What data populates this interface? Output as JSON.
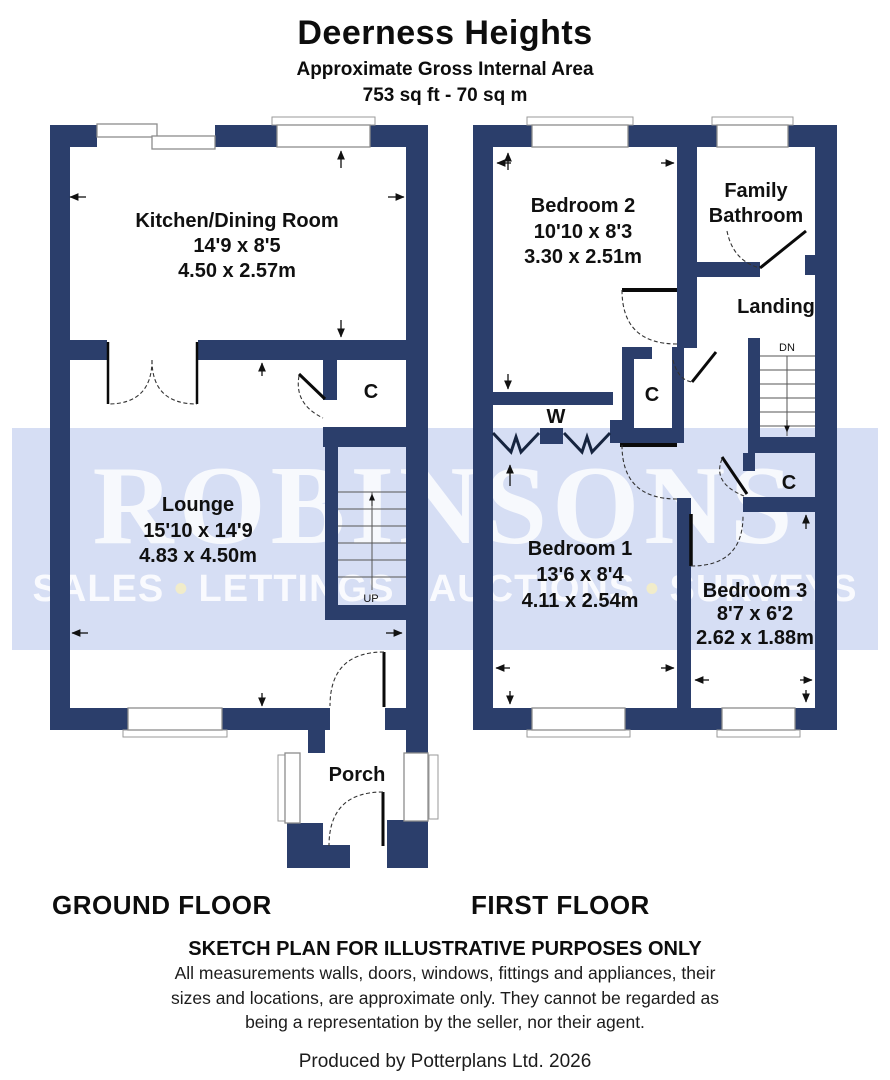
{
  "header": {
    "title": "Deerness Heights",
    "subtitle": "Approximate Gross Internal Area",
    "area": "753 sq ft - 70 sq m"
  },
  "watermark": {
    "brand": "ROBINSONS",
    "services": [
      "SALES",
      "LETTINGS",
      "AUCTIONS",
      "SURVEYS"
    ],
    "separator": "•"
  },
  "floors": {
    "ground": {
      "label": "GROUND FLOOR",
      "stairs_label": "UP",
      "rooms": {
        "kitchen": {
          "name": "Kitchen/Dining Room",
          "imperial": "14'9 x 8'5",
          "metric": "4.50 x 2.57m"
        },
        "lounge": {
          "name": "Lounge",
          "imperial": "15'10 x 14'9",
          "metric": "4.83 x 4.50m"
        },
        "cupboard": {
          "name": "C"
        },
        "porch": {
          "name": "Porch"
        }
      }
    },
    "first": {
      "label": "FIRST FLOOR",
      "stairs_label": "DN",
      "rooms": {
        "bedroom2": {
          "name": "Bedroom 2",
          "imperial": "10'10 x 8'3",
          "metric": "3.30 x 2.51m"
        },
        "bathroom": {
          "name_lines": [
            "Family",
            "Bathroom"
          ]
        },
        "landing": {
          "name": "Landing"
        },
        "wardrobe": {
          "name": "W"
        },
        "cupboard_mid": {
          "name": "C"
        },
        "cupboard_right": {
          "name": "C"
        },
        "bedroom1": {
          "name": "Bedroom 1",
          "imperial": "13'6 x 8'4",
          "metric": "4.11 x 2.54m"
        },
        "bedroom3": {
          "name": "Bedroom 3",
          "imperial": "8'7 x 6'2",
          "metric": "2.62 x 1.88m"
        }
      }
    }
  },
  "footer": {
    "disclaimer_title": "SKETCH PLAN FOR ILLUSTRATIVE PURPOSES ONLY",
    "disclaimer_lines": [
      "All measurements walls, doors, windows, fittings and appliances, their",
      "sizes and locations, are approximate only. They cannot be regarded as",
      "being a representation by the seller, nor their agent."
    ],
    "credit": "Produced by Potterplans Ltd. 2026"
  },
  "colors": {
    "wall_navy": "#2b3e6b",
    "watermark_band": "#d6def4",
    "watermark_text": "#f3f6fc",
    "watermark_dot": "#f1ecca"
  }
}
